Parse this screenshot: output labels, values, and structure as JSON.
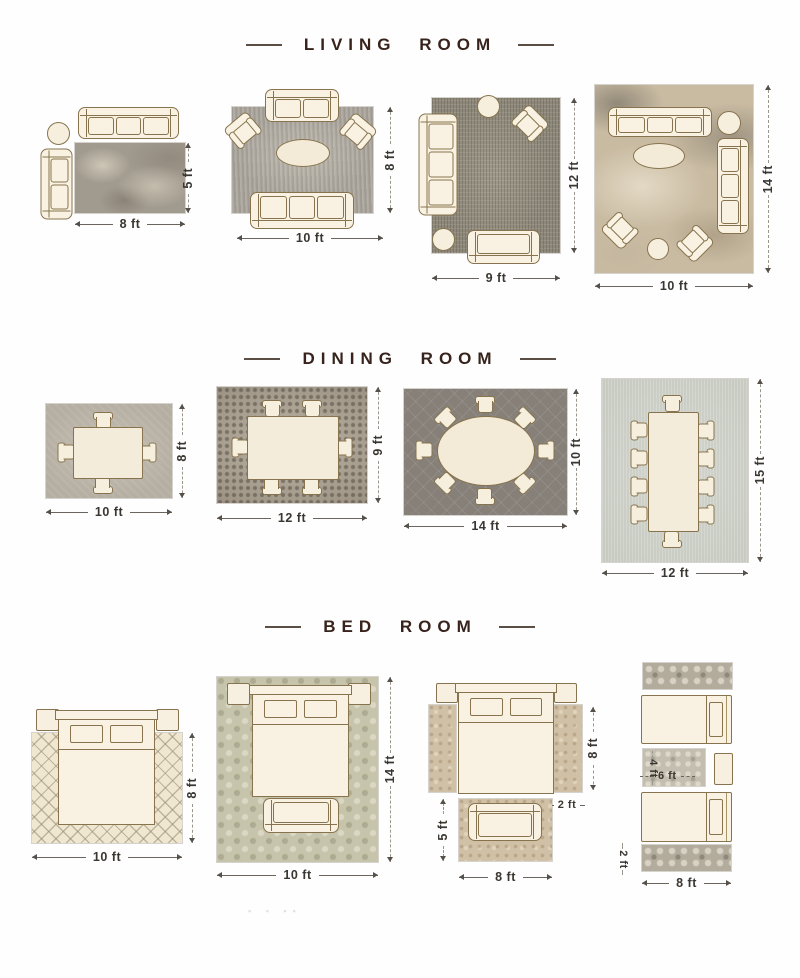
{
  "page": {
    "background": "#fefefe",
    "watermark": "▪ ▪ ▪▪"
  },
  "colors": {
    "furniture_fill": "#f9f2e2",
    "furniture_outline": "#87744e",
    "header_text": "#38231c",
    "header_dash": "#5b4f45",
    "dimension_text": "#3a3631",
    "dimension_line": "#6a655e"
  },
  "sections": [
    {
      "id": "living-room",
      "title": "LIVING ROOM",
      "layouts": [
        {
          "name": "living-8x5",
          "width_ft": 8,
          "height_ft": 5,
          "bottom_label": "8 ft",
          "side_label": "5 ft",
          "rug_style": "mottled-gray",
          "furniture": [
            "sofa",
            "chaise",
            "round-side-table"
          ]
        },
        {
          "name": "living-10x8",
          "width_ft": 10,
          "height_ft": 8,
          "bottom_label": "10 ft",
          "side_label": "8 ft",
          "rug_style": "gray-shag",
          "furniture": [
            "sofa",
            "sofa",
            "accent-chair",
            "accent-chair",
            "oval-coffee-table"
          ]
        },
        {
          "name": "living-9x12",
          "width_ft": 9,
          "height_ft": 12,
          "bottom_label": "9 ft",
          "side_label": "12 ft",
          "rug_style": "distressed-gray",
          "furniture": [
            "sofa",
            "loveseat",
            "accent-chair",
            "round-side-table",
            "round-side-table"
          ]
        },
        {
          "name": "living-10x14",
          "width_ft": 10,
          "height_ft": 14,
          "bottom_label": "10 ft",
          "side_label": "14 ft",
          "rug_style": "abstract-beige",
          "furniture": [
            "sofa",
            "sofa",
            "accent-chair",
            "accent-chair",
            "oval-coffee-table",
            "round-side-table",
            "round-side-table"
          ]
        }
      ]
    },
    {
      "id": "dining-room",
      "title": "DINING ROOM",
      "layouts": [
        {
          "name": "dining-10x8",
          "width_ft": 10,
          "height_ft": 8,
          "bottom_label": "10 ft",
          "side_label": "8 ft",
          "rug_style": "textured-gray",
          "furniture": [
            "dining-table",
            "dining-chair x4"
          ]
        },
        {
          "name": "dining-12x9",
          "width_ft": 12,
          "height_ft": 9,
          "bottom_label": "12 ft",
          "side_label": "9 ft",
          "rug_style": "mosaic-gray",
          "furniture": [
            "dining-table",
            "dining-chair x6"
          ]
        },
        {
          "name": "dining-14x10",
          "width_ft": 14,
          "height_ft": 10,
          "bottom_label": "14 ft",
          "side_label": "10 ft",
          "rug_style": "dark-trellis",
          "furniture": [
            "oval-dining-table",
            "dining-chair x8"
          ]
        },
        {
          "name": "dining-12x15",
          "width_ft": 12,
          "height_ft": 15,
          "bottom_label": "12 ft",
          "side_label": "15 ft",
          "rug_style": "silver-sage",
          "furniture": [
            "dining-table",
            "dining-chair x10"
          ]
        }
      ]
    },
    {
      "id": "bed-room",
      "title": "BED ROOM",
      "layouts": [
        {
          "name": "bed-10x8",
          "width_ft": 10,
          "height_ft": 8,
          "bottom_label": "10 ft",
          "side_label": "8 ft",
          "rug_style": "moroccan-trellis-cream",
          "furniture": [
            "queen-bed",
            "nightstand x2"
          ]
        },
        {
          "name": "bed-10x14",
          "width_ft": 10,
          "height_ft": 14,
          "bottom_label": "10 ft",
          "side_label": "14 ft",
          "rug_style": "sage-damask",
          "furniture": [
            "queen-bed",
            "nightstand x2",
            "bench"
          ]
        },
        {
          "name": "bed-side-runners",
          "runner_width_ft": 2,
          "runner_length_ft": 8,
          "foot_rug_w_ft": 8,
          "foot_rug_h_ft": 5,
          "side_label": "8 ft",
          "runner_label": "2 ft",
          "foot_side_label": "5 ft",
          "bottom_label": "8 ft",
          "rug_style": "tan-persian",
          "furniture": [
            "queen-bed",
            "nightstand x2",
            "runner x2",
            "bench"
          ]
        },
        {
          "name": "bed-twin-runners",
          "runner_width_ft": 2,
          "runner_length_ft": 8,
          "small_rug_w_ft": 4,
          "small_rug_l_ft": 6,
          "small_width_label": "4 ft",
          "small_length_label": "6 ft",
          "runner_label": "2 ft",
          "bottom_label": "8 ft",
          "rug_style": "gray-ornate",
          "furniture": [
            "twin-bed x2",
            "nightstand",
            "runner x2",
            "small-rug"
          ]
        }
      ]
    }
  ]
}
